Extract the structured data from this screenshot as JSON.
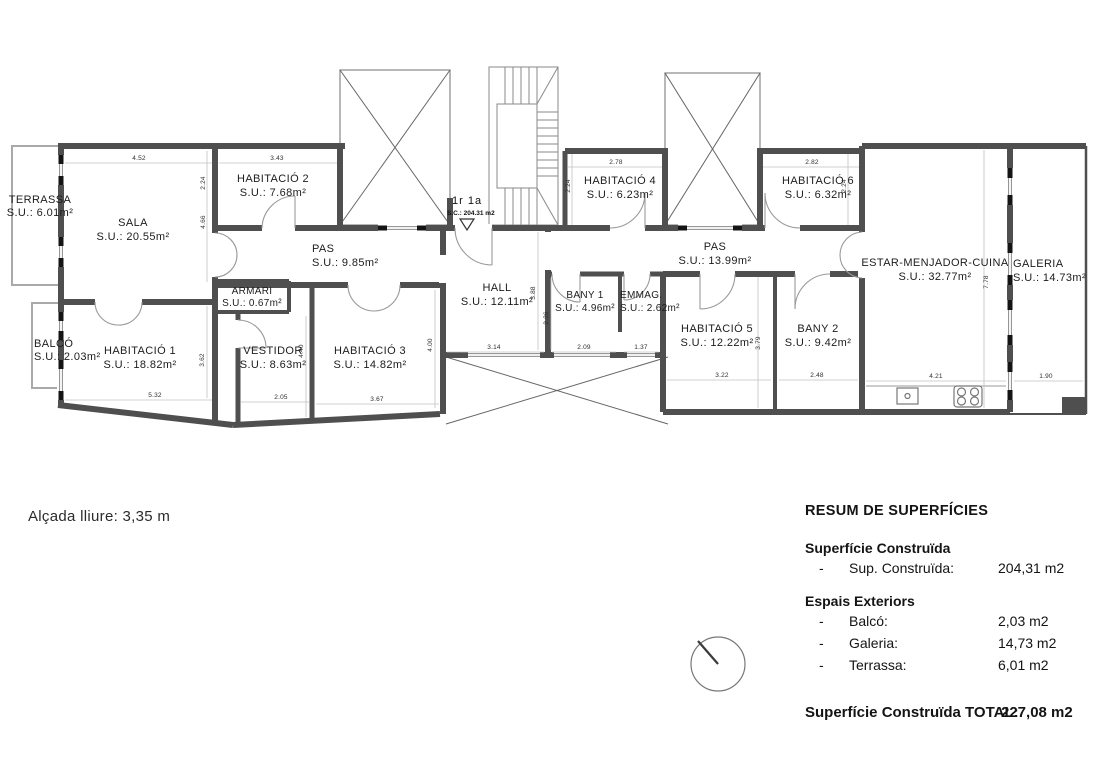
{
  "plan": {
    "rooms": {
      "terrassa": {
        "name": "TERRASSA",
        "area": "S.U.: 6.01m²"
      },
      "sala": {
        "name": "SALA",
        "area": "S.U.: 20.55m²"
      },
      "habitacio2": {
        "name": "HABITACIÓ 2",
        "area": "S.U.: 7.68m²"
      },
      "pas1": {
        "name": "PAS",
        "area": "S.U.: 9.85m²"
      },
      "armari": {
        "name": "ARMARI",
        "area": "S.U.: 0.67m²"
      },
      "balco": {
        "name": "BALCÓ",
        "area": "S.U.: 2.03m²"
      },
      "habitacio1": {
        "name": "HABITACIÓ 1",
        "area": "S.U.: 18.82m²"
      },
      "vestidor": {
        "name": "VESTIDOR",
        "area": "S.U.: 8.63m²"
      },
      "habitacio3": {
        "name": "HABITACIÓ 3",
        "area": "S.U.: 14.82m²"
      },
      "hall": {
        "name": "HALL",
        "area": "S.U.: 12.11m²"
      },
      "habitacio4": {
        "name": "HABITACIÓ 4",
        "area": "S.U.: 6.23m²"
      },
      "habitacio6": {
        "name": "HABITACIÓ 6",
        "area": "S.U.: 6.32m²"
      },
      "pas2": {
        "name": "PAS",
        "area": "S.U.: 13.99m²"
      },
      "bany1": {
        "name": "BANY 1",
        "area": "S.U.: 4.96m²"
      },
      "emmag": {
        "name": "EMMAG.",
        "area": "S.U.: 2.62m²"
      },
      "habitacio5": {
        "name": "HABITACIÓ 5",
        "area": "S.U.: 12.22m²"
      },
      "bany2": {
        "name": "BANY 2",
        "area": "S.U.: 9.42m²"
      },
      "estar": {
        "name": "ESTAR-MENJADOR-CUINA",
        "area": "S.U.: 32.77m²"
      },
      "galeria": {
        "name": "GALERIA",
        "area": "S.U.: 14.73m²"
      }
    },
    "entrance": {
      "unit": "1r 1a",
      "sc": "S.C.: 204.31 m2"
    },
    "dims": {
      "top_sala": "4.52",
      "top_hab2": "3.43",
      "top_hab4": "2.78",
      "top_hab6": "2.82",
      "v_hab2": "2.24",
      "v_sala": "4.66",
      "v_hab4": "2.24",
      "v_hab6": "2.24",
      "v_cuina": "7.78",
      "v_hab1": "3.62",
      "v_vestidor": "4.40",
      "v_hab3": "4.00",
      "v_hall": "3.88",
      "v_bany1": "2.26",
      "v_hab5": "3.79",
      "b_hab1": "5.32",
      "b_vestidor": "2.05",
      "b_hab3": "3.67",
      "b_hall": "3.14",
      "b_bany1": "2.09",
      "b_emmag": "1.37",
      "b_hab5": "3.22",
      "b_bany2": "2.48",
      "b_cuina": "4.21",
      "b_galeria": "1.90"
    }
  },
  "note": "Alçada lliure: 3,35 m",
  "summary": {
    "title": "RESUM DE SUPERFÍCIES",
    "built_header": "Superfície Construïda",
    "dash": "-",
    "built_label": "Sup. Construïda:",
    "built_value": "204,31 m2",
    "ext_header": "Espais Exteriors",
    "items": [
      {
        "label": "Balcó:",
        "value": "2,03 m2"
      },
      {
        "label": "Galeria:",
        "value": "14,73 m2"
      },
      {
        "label": "Terrassa:",
        "value": "6,01 m2"
      }
    ],
    "total_label": "Superfície Construïda TOTAL:",
    "total_value": "227,08 m2"
  }
}
